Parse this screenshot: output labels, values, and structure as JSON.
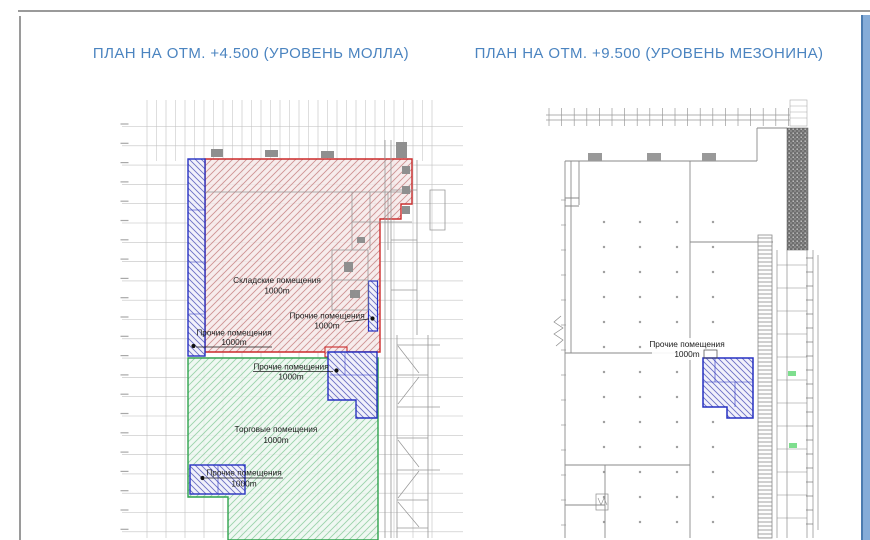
{
  "titles": {
    "left": "ПЛАН НА ОТМ. +4.500 (УРОВЕНЬ МОЛЛА)",
    "right": "ПЛАН НА ОТМ. +9.500 (УРОВЕНЬ МЕЗОНИНА)"
  },
  "left_plan": {
    "regions": [
      {
        "id": "warehouse",
        "label": "Складские помещения",
        "area": "1000m",
        "color": "#cc2a2a"
      },
      {
        "id": "other-left",
        "label": "Прочие помещения",
        "area": "1000m",
        "color": "#2630c2"
      },
      {
        "id": "other-right",
        "label": "Прочие помещения",
        "area": "1000m",
        "color": "#2630c2"
      },
      {
        "id": "other-mid",
        "label": "Прочие помещения",
        "area": "1000m",
        "color": "#2630c2"
      },
      {
        "id": "trade",
        "label": "Торговые помещения",
        "area": "1000m",
        "color": "#2fa24d"
      },
      {
        "id": "other-bottom",
        "label": "Прочие помещения",
        "area": "1000m",
        "color": "#2630c2"
      }
    ]
  },
  "right_plan": {
    "regions": [
      {
        "id": "other",
        "label": "Прочие помещения",
        "area": "1000m",
        "color": "#2630c2"
      }
    ]
  },
  "colors": {
    "title_text": "#4b84c0",
    "warehouse_border": "#cc2a2a",
    "other_border": "#2630c2",
    "trade_border": "#2fa24d",
    "edge_bar": "#85acd8",
    "grid": "#c9c9c9"
  }
}
